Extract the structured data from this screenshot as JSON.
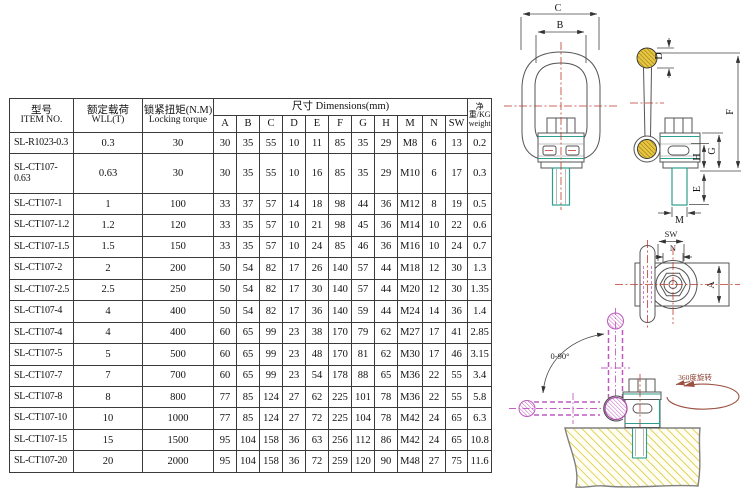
{
  "table": {
    "col_item": {
      "zh": "型号",
      "en": "ITEM NO."
    },
    "col_wll": {
      "zh": "额定载荷",
      "en": "WLL(T)"
    },
    "col_torque": {
      "zh": "锁紧扭矩(N.M)",
      "en": "Locking torque"
    },
    "col_dims": "尺寸  Dimensions(mm)",
    "col_weight": {
      "zh": "净重/KG",
      "en": "weight"
    },
    "dim_letters": [
      "A",
      "B",
      "C",
      "D",
      "E",
      "F",
      "G",
      "H",
      "M",
      "N",
      "SW"
    ],
    "rows": [
      {
        "item": "SL-R1023-0.3",
        "wll": "0.3",
        "torque": "30",
        "dims": [
          "30",
          "35",
          "55",
          "10",
          "11",
          "85",
          "35",
          "29",
          "M8",
          "6",
          "13"
        ],
        "weight": "0.2"
      },
      {
        "item": "SL-CT107-0.63",
        "wll": "0.63",
        "torque": "30",
        "dims": [
          "30",
          "35",
          "55",
          "10",
          "16",
          "85",
          "35",
          "29",
          "M10",
          "6",
          "17"
        ],
        "weight": "0.3"
      },
      {
        "item": "SL-CT107-1",
        "wll": "1",
        "torque": "100",
        "dims": [
          "33",
          "37",
          "57",
          "14",
          "18",
          "98",
          "44",
          "36",
          "M12",
          "8",
          "19"
        ],
        "weight": "0.5"
      },
      {
        "item": "SL-CT107-1.2",
        "wll": "1.2",
        "torque": "120",
        "dims": [
          "33",
          "35",
          "57",
          "10",
          "21",
          "98",
          "45",
          "36",
          "M14",
          "10",
          "22"
        ],
        "weight": "0.6"
      },
      {
        "item": "SL-CT107-1.5",
        "wll": "1.5",
        "torque": "150",
        "dims": [
          "33",
          "35",
          "57",
          "10",
          "24",
          "85",
          "46",
          "36",
          "M16",
          "10",
          "24"
        ],
        "weight": "0.7"
      },
      {
        "item": "SL-CT107-2",
        "wll": "2",
        "torque": "200",
        "dims": [
          "50",
          "54",
          "82",
          "17",
          "26",
          "140",
          "57",
          "44",
          "M18",
          "12",
          "30"
        ],
        "weight": "1.3"
      },
      {
        "item": "SL-CT107-2.5",
        "wll": "2.5",
        "torque": "250",
        "dims": [
          "50",
          "54",
          "82",
          "17",
          "30",
          "140",
          "57",
          "44",
          "M20",
          "12",
          "30"
        ],
        "weight": "1.35"
      },
      {
        "item": "SL-CT107-4",
        "wll": "4",
        "torque": "400",
        "dims": [
          "50",
          "54",
          "82",
          "17",
          "36",
          "140",
          "59",
          "44",
          "M24",
          "14",
          "36"
        ],
        "weight": "1.4"
      },
      {
        "item": "SL-CT107-4",
        "wll": "4",
        "torque": "400",
        "dims": [
          "60",
          "65",
          "99",
          "23",
          "38",
          "170",
          "79",
          "62",
          "M27",
          "17",
          "41"
        ],
        "weight": "2.85"
      },
      {
        "item": "SL-CT107-5",
        "wll": "5",
        "torque": "500",
        "dims": [
          "60",
          "65",
          "99",
          "23",
          "48",
          "170",
          "81",
          "62",
          "M30",
          "17",
          "46"
        ],
        "weight": "3.15"
      },
      {
        "item": "SL-CT107-7",
        "wll": "7",
        "torque": "700",
        "dims": [
          "60",
          "65",
          "99",
          "23",
          "54",
          "178",
          "88",
          "65",
          "M36",
          "22",
          "55"
        ],
        "weight": "3.4"
      },
      {
        "item": "SL-CT107-8",
        "wll": "8",
        "torque": "800",
        "dims": [
          "77",
          "85",
          "124",
          "27",
          "62",
          "225",
          "101",
          "78",
          "M36",
          "22",
          "55"
        ],
        "weight": "5.8"
      },
      {
        "item": "SL-CT107-10",
        "wll": "10",
        "torque": "1000",
        "dims": [
          "77",
          "85",
          "124",
          "27",
          "72",
          "225",
          "104",
          "78",
          "M42",
          "24",
          "65"
        ],
        "weight": "6.3"
      },
      {
        "item": "SL-CT107-15",
        "wll": "15",
        "torque": "1500",
        "dims": [
          "95",
          "104",
          "158",
          "36",
          "63",
          "256",
          "112",
          "86",
          "M42",
          "24",
          "65"
        ],
        "weight": "10.8"
      },
      {
        "item": "SL-CT107-20",
        "wll": "20",
        "torque": "2000",
        "dims": [
          "95",
          "104",
          "158",
          "36",
          "72",
          "259",
          "120",
          "90",
          "M48",
          "27",
          "75"
        ],
        "weight": "11.6"
      }
    ]
  },
  "drawing": {
    "labels": {
      "c": "C",
      "b": "B",
      "d": "D",
      "f": "F",
      "g": "G",
      "h": "H",
      "e": "E",
      "m": "M",
      "sw": "SW",
      "n": "N",
      "a": "A"
    },
    "annotations": {
      "swing": "0-90°",
      "rotate": "360度旋转"
    },
    "colors": {
      "centerline": "#C0392B",
      "accent_green": "#2E9E8E",
      "hatch_yellow": "#E9C63F",
      "hatch_pink": "#C25FC2",
      "base_hatch": "#D9C428",
      "rotate_arrow": "#9B5040"
    }
  }
}
